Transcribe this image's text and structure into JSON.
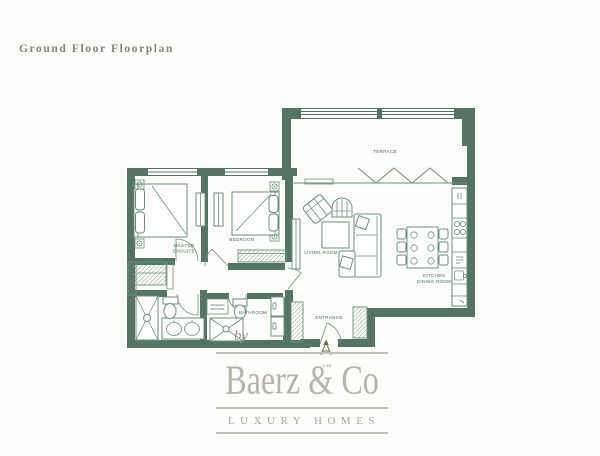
{
  "title": "Ground Floor Floorplan",
  "floorplan": {
    "wall_color": "#567466",
    "line_color": "#6d8e7e",
    "label_color": "#4e6e60",
    "labels": {
      "terrace": "TERRACE",
      "living_room": "LIVING ROOM",
      "kitchen_line1": "KITCHEN",
      "kitchen_line2": "DINING ROOM",
      "master_line1": "MASTER",
      "master_line2": "ENSUITE",
      "bedroom": "BEDROOM",
      "bathroom": "BATHROOM",
      "entrance": "ENTRANCE",
      "utility_line1": "WASHING",
      "utility_line2": "MACHINE",
      "scale": "1:85"
    }
  },
  "logo": {
    "by": "by",
    "name": "Baerz & Co",
    "tagline": "LUXURY HOMES",
    "text_color": "#b8b4ad"
  }
}
